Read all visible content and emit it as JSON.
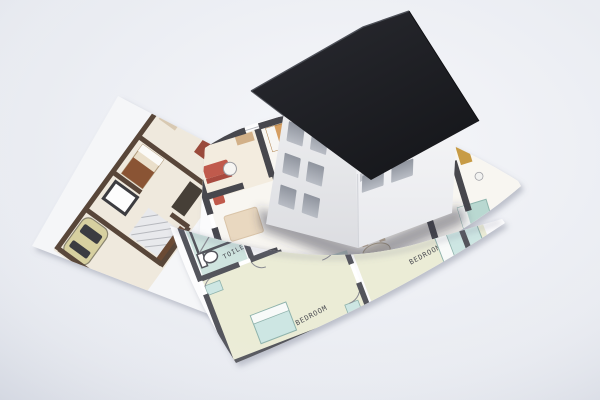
{
  "scene": {
    "width": 600,
    "height": 400
  },
  "background": {
    "center": "#f6f7fa",
    "edge": "#e4e7ee"
  },
  "sheets": {
    "left_paper": "#f5f6f8",
    "middle_paper": "#fbfbfc",
    "front_paper": "#fcfcfd",
    "shadow": "rgba(120,126,145,0.42)"
  },
  "house": {
    "roof_top": "#2a2b31",
    "roof_bottom": "#16171b",
    "roof_edge_light": "#4d5058",
    "gable_wall_top": "#ecedef",
    "gable_wall_bottom": "#dcdde1",
    "side_wall_top": "#f5f5f7",
    "side_wall_bottom": "#e8e9ed",
    "window_top": "#8f949e",
    "window_bottom": "#b9bdc5",
    "eave_shadow": "rgba(90,95,112,0.30)",
    "corner_line": "#d3d5da",
    "ground_shadow": "rgba(52,55,68,0.45)"
  },
  "plans": {
    "foreground": {
      "wall": "#54555c",
      "line": "#8a8b92",
      "floor_yellow": "#ebecd6",
      "floor_teal": "#cfe4df",
      "bed_teal": "#cde6e3",
      "labels": {
        "shower": "SHWR",
        "toilet": "TOILET",
        "bedroom_main": "BEDROOM",
        "bedroom_right": "BEDROOM"
      }
    },
    "middle": {
      "wall": "#47474d",
      "floor": "#f8f6f1",
      "tint_warm": "#f3ecdf",
      "sofa_red": "#c05a4c",
      "wood_tan": "#d59e61",
      "gold": "#c79b45",
      "teal": "#b9d8d1",
      "rug": "#e9d8c0",
      "tile": "#eef0f2",
      "tile_line": "#c6c8cd",
      "plant": "#85a061",
      "dark_fixture": "#3f4045",
      "counter": "#d3d4d7"
    },
    "left": {
      "wall": "#584639",
      "floor": "#efe9dd",
      "accent_red": "#9a4a3b",
      "blanket": "#8a5434",
      "bed_base": "#eadfca",
      "dark_furniture": "#463f37",
      "car_body": "#d7d0a0",
      "car_window": "#3b3c41",
      "hatch": "#b7b9be"
    }
  }
}
